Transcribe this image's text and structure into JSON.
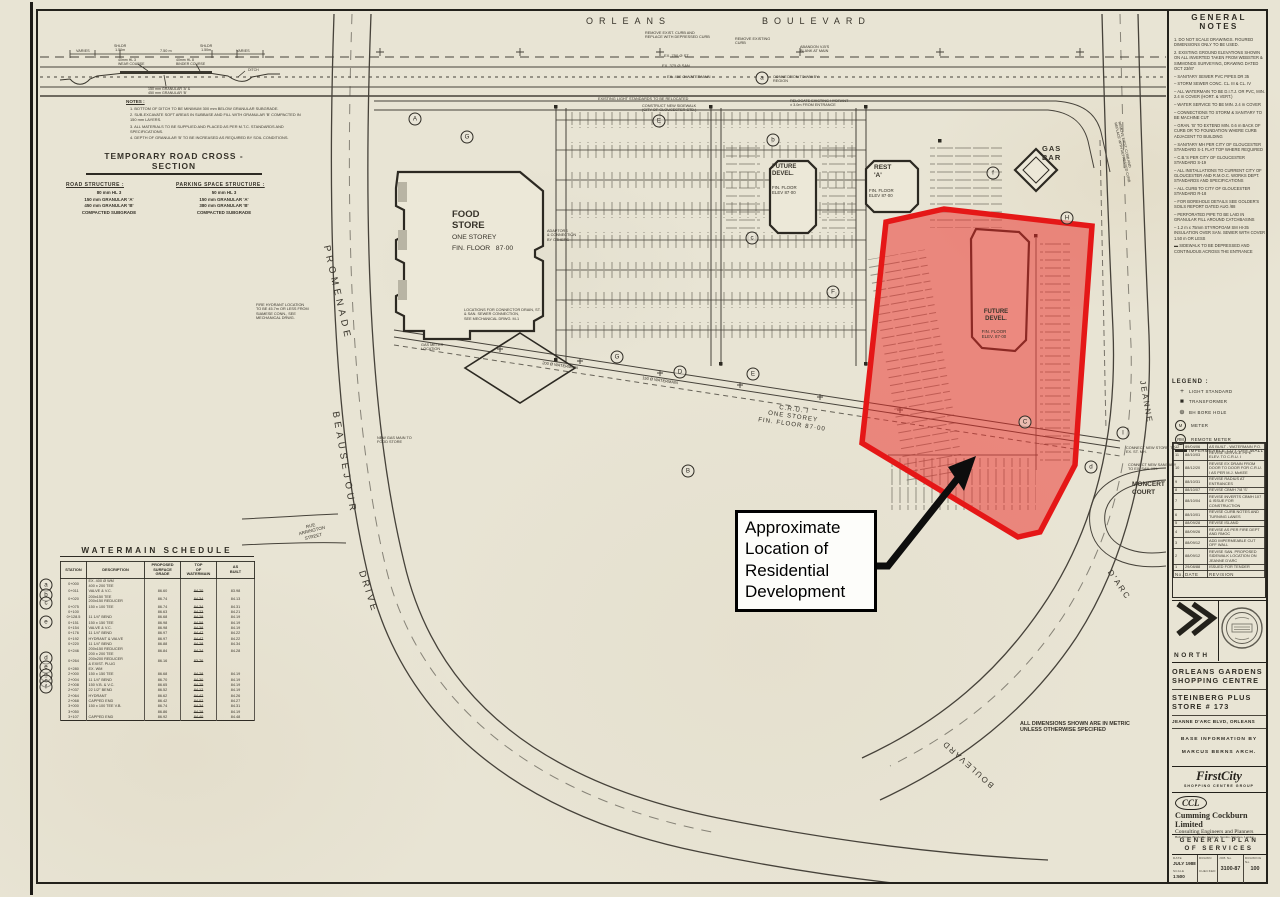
{
  "annotation": {
    "text": "Approximate\nLocation of\nResidential\nDevelopment"
  },
  "colors": {
    "paper": "#e8e4d4",
    "ink": "#2f2c24",
    "highlight_fill": "rgba(236,42,38,0.5)",
    "highlight_stroke": "#e51717",
    "arrow": "#0d0d0d"
  },
  "general_notes": {
    "title": "GENERAL NOTES",
    "items": [
      "1.  DO NOT SCALE DRAWINGS. FIGURED DIMENSIONS ONLY TO BE USED.",
      "2.  EXISTING GROUND ELEVATIONS SHOWN ON ALL INVERTED TAKEN FROM WEBSTER & SIMMONDS SURVEYING, DRAWING DATED OCT 23/87",
      "–  SANITARY SEWER PVC PIPES DR 35",
      "–  STORM SEWER CONC. CL. III & CL. IV",
      "–  ALL WATERMAIN TO BE D.I.T.J. OR PVC, MIN. 2.4 m COVER (HORT. & VERT.)",
      "–  WATER SERVICE TO BE MIN. 2.4 m COVER",
      "–  CONNECTIONS TO STORM & SANITARY TO BE MACHINE CUT",
      "–  GRAN. 'B' TO EXTEND MIN. 0.6 m BACK OF CURB OR TO FOUNDATION WHERE CURB ADJACENT TO BUILDING",
      "–  SANITARY MH PER CITY OF GLOUCESTER STANDARD S-1 FLAT TOP WHERE REQUIRED",
      "–  C.B.'S PER CITY OF GLOUCESTER STANDARD S-19",
      "–  ALL INSTALLATIONS TO CURRENT CITY OF GLOUCESTER AND R.M.O.C. WORKS DEPT. STANDARDS AND SPECIFICATIONS",
      "–  ALL CURB TO CITY OF GLOUCESTER STANDARD R-18",
      "–  FOR BOREHOLE DETAILS SEE GOLDER'S SOILS REPORT DATED AUG /88",
      "–  PERFORATED PIPE TO BE LAID IN GRANULAR FILL AROUND CATCHBASINS",
      "–  1.2 m x 75mm STYROFOAM SM HI-35 INSULATION OVER SAN. SEWER WITH COVER 1.50 m OR LESS",
      "▬  SIDEWALK TO BE DEPRESSED AND CONTINUOUS ACROSS THE ENTRANCE"
    ]
  },
  "legend": {
    "title": "LEGEND :",
    "items": [
      {
        "sym": "+",
        "cls": "plus",
        "label": "LIGHT STANDARD"
      },
      {
        "sym": "■",
        "cls": "sq",
        "label": "TRANSFORMER"
      },
      {
        "sym": "⊕",
        "cls": "bh",
        "label": "BH  BORE HOLE"
      },
      {
        "sym": "M",
        "cls": "circ",
        "label": "METER"
      },
      {
        "sym": "RM",
        "cls": "circ",
        "label": "REMOTE METER"
      },
      {
        "sym": "",
        "cls": "bar",
        "label": "IMPERMEABLE CUT OFF WALL"
      }
    ]
  },
  "revisions": {
    "headers": [
      "No.",
      "DATE",
      "REVISION"
    ],
    "rows": [
      [
        "12",
        "89/04/06",
        "AS BUILT - WATERMAIN   P.O."
      ],
      [
        "11",
        "88/10/03",
        "REVISE SERVICE PIPE ELEV. TO C.R.U. I"
      ],
      [
        "10",
        "88/12/20",
        "REVISE EX DRAIN FROM DOOR TO DOOR FOR C.R.U. I AS PER M.J. McKEE"
      ],
      [
        "9",
        "88/10/31",
        "REVISE RADIUS AT ENTRANCES"
      ],
      [
        "8",
        "88/10/07",
        "REVISE CBMH 7/8 'S'"
      ],
      [
        "7",
        "88/10/04",
        "REVISE INVERTS CBMH 107 & ISSUE FOR CONSTRUCTION"
      ],
      [
        "6",
        "88/10/01",
        "REVISE CURB NOTES AND TURNING LANES"
      ],
      [
        "5",
        "88/09/28",
        "REVISE ISLAND"
      ],
      [
        "4",
        "88/09/26",
        "REVISE AS PER FIRE DEPT AND RMOC"
      ],
      [
        "3",
        "88/09/12",
        "ADD IMPERMEABLE CUT OFF WALL"
      ],
      [
        "2",
        "88/09/12",
        "REVISE SAN. PROPOSED SIDEWALK LOCATION ON JEANNE D'ARC"
      ],
      [
        "1",
        "29/08/88",
        "ISSUED FOR TENDER"
      ]
    ]
  },
  "title_block": {
    "north_label": "NORTH",
    "project_line1": "ORLEANS GARDENS\nSHOPPING CENTRE",
    "project_line2": "STEINBERG PLUS\nSTORE # 173",
    "address": "JEANNE D'ARC BLVD, ORLEANS",
    "base_info1": "BASE  INFORMATION  BY",
    "base_info2": "MARCUS  BERNS  ARCH.",
    "firstcity_logo": "FirstCity",
    "firstcity_sub": "SHOPPING CENTRE GROUP",
    "ccl_logo": "CCL",
    "ccl_name": "Cumming Cockburn Limited",
    "ccl_tag": "Consulting Engineers and Planners",
    "ccl_cities": "Hull, Ottawa, Brockville, Kingston, Toronto, Waterloo, London",
    "drawing_title": "GENERAL   PLAN\nOF   SERVICES",
    "fields": {
      "date_label": "DATE",
      "date_value": "JULY 1988",
      "scale_label": "SCALE",
      "scale_value": "1:500",
      "drawn_label": "DRAWN",
      "checked_label": "CHECKED",
      "job_label": "JOB No.",
      "job_value": "3100-87",
      "dwg_label": "DRAWING No.",
      "dwg_value": "100"
    }
  },
  "cross_section": {
    "title": "TEMPORARY  ROAD  CROSS - SECTION",
    "notes_title": "NOTES :",
    "notes": [
      "1.  BOTTOM OF DITCH TO BE MINIMUM 300 mm BELOW GRANULAR SUBGRADE.",
      "2.  SUB-EXCAVATE SOFT AREAS IN SUBBASE AND FILL WITH GRANULAR 'B' COMPACTED IN 150 mm LAYERS.",
      "3.  ALL MATERIALS TO BE SUPPLIED AND PLACED AS PER M.T.C. STANDARDS AND SPECIFICATIONS.",
      "4.  DEPTH OF GRANULAR 'B' TO BE INCREASED AS REQUIRED BY SOIL CONDITIONS."
    ],
    "road_structure_title": "ROAD  STRUCTURE :",
    "road_structure_lines": "80 mm HL 3\n150 mm GRANULAR 'A'\n450 mm GRANULAR 'B'\nCOMPACTED SUBGRADE",
    "parking_structure_title": "PARKING  SPACE  STRUCTURE :",
    "parking_structure_lines": "50 mm HL 3\n150 mm GRANULAR 'A'\n380 mm GRANULAR 'B'\nCOMPACTED SUBGRADE"
  },
  "watermain_schedule": {
    "title": "WATERMAIN  SCHEDULE",
    "headers": [
      "STATION",
      "DESCRIPTION",
      "PROPOSED\nSURFACE\nGRADE",
      "TOP\nOF\nWATERMAIN",
      "AS\nBUILT"
    ],
    "rows": [
      [
        "0+000",
        "EX. 400 Ø WM\n400 x 200 TEE",
        "",
        "",
        ""
      ],
      [
        "0+011",
        "VALVE & V.C.",
        "86.60",
        "84.20",
        "83.98"
      ],
      [
        "0+020",
        "200x150 TEE\n200x150 REDUCER",
        "86.74",
        "84.34",
        "84.13"
      ],
      [
        "0+075",
        "150 x 100 TEE",
        "86.74",
        "84.34",
        "84.31"
      ],
      [
        "0+100",
        "",
        "86.63",
        "84.23",
        "84.21"
      ],
      [
        "0+128.5",
        "11 1/4° BEND",
        "86.68",
        "84.28",
        "84.19"
      ],
      [
        "0+151",
        "150 x 150 TEE",
        "86.98",
        "84.58",
        "84.19"
      ],
      [
        "0+154",
        "VALVE & V.C.",
        "86.98",
        "84.38",
        "84.19"
      ],
      [
        "0+176",
        "11 1/4° BEND",
        "86.97",
        "84.47",
        "84.22"
      ],
      [
        "0+192",
        "HYDRANT & VALVE",
        "86.97",
        "84.47",
        "84.22"
      ],
      [
        "0+220",
        "11 1/4° BEND",
        "86.88",
        "84.28",
        "84.34"
      ],
      [
        "0+246",
        "200x150 REDUCER\n200 x 200 TEE",
        "86.84",
        "84.24",
        "84.28"
      ],
      [
        "0+264",
        "200x200 REDUCER\n& EXIST. PLUG",
        "86.16",
        "83.76",
        ""
      ],
      [
        "0+280",
        "EX.  WM",
        "",
        "",
        ""
      ],
      [
        "2+000",
        "150 x 150 TEE",
        "86.68",
        "84.28",
        "84.19"
      ],
      [
        "2+004",
        "11 1/4° BEND",
        "86.70",
        "84.30",
        "84.19"
      ],
      [
        "2+008",
        "150 V.B. & V.C.",
        "86.65",
        "84.25",
        "84.19"
      ],
      [
        "2+037",
        "22 1/2° BEND",
        "86.52",
        "84.12",
        "84.19"
      ],
      [
        "2+064",
        "HYDRANT",
        "86.62",
        "84.42",
        "84.26"
      ],
      [
        "2+068",
        "CAPPED END",
        "86.42",
        "84.02",
        "84.27"
      ],
      [
        "3+000",
        "150 x 100 TEE V.B.",
        "86.74",
        "84.34",
        "84.31"
      ],
      [
        "3+050",
        "",
        "86.86",
        "84.28",
        "84.19"
      ],
      [
        "3+107",
        "CAPPED END",
        "86.92",
        "84.40",
        "84.48"
      ]
    ]
  },
  "plan": {
    "labels": [
      {
        "t": "ORLEANS",
        "x": 586,
        "y": 16,
        "s": 9,
        "ls": 6,
        "n": "street-label-orleans"
      },
      {
        "t": "BOULEVARD",
        "x": 762,
        "y": 16,
        "s": 9,
        "ls": 6,
        "n": "street-label-boulevard-top"
      },
      {
        "t": "PROMENADE",
        "cx": 337,
        "cy": 293,
        "s": 9.5,
        "ls": 4,
        "r": 77,
        "n": "street-label-promenade"
      },
      {
        "t": "BEAUSEJOUR",
        "cx": 344,
        "cy": 463,
        "s": 9.5,
        "ls": 4,
        "r": 80,
        "n": "street-label-beausejour"
      },
      {
        "t": "DRIVE",
        "cx": 368,
        "cy": 592,
        "s": 9.5,
        "ls": 3,
        "r": 72,
        "n": "street-label-drive"
      },
      {
        "t": "RUE\nARRINGTON\nSTREET",
        "cx": 312,
        "cy": 531,
        "s": 4.5,
        "r": -14,
        "al": "center",
        "n": "street-label-rue-arrington"
      },
      {
        "t": "JEANNE",
        "cx": 1146,
        "cy": 402,
        "s": 8,
        "ls": 2,
        "r": 80,
        "n": "street-label-jeanne"
      },
      {
        "t": "MONCERT\nCOURT",
        "x": 1132,
        "y": 481,
        "s": 6.5,
        "w": 700,
        "n": "street-label-moncert-court"
      },
      {
        "t": "D'ARC",
        "cx": 1119,
        "cy": 585,
        "s": 8,
        "ls": 2,
        "r": 56,
        "n": "street-label-darc"
      },
      {
        "t": "BOULEVARD",
        "cx": 968,
        "cy": 764,
        "s": 8,
        "ls": 2,
        "r": 222,
        "n": "street-label-boulevard-bottom"
      },
      {
        "t": "FOOD\nSTORE",
        "x": 452,
        "y": 209,
        "s": 9.5,
        "w": 700,
        "n": "building-label-food-store"
      },
      {
        "t": "ONE STOREY",
        "x": 452,
        "y": 234,
        "s": 6.8,
        "n": "building-label-food-store-storey"
      },
      {
        "t": "FIN. FLOOR   87·00",
        "x": 452,
        "y": 245,
        "s": 6.8,
        "n": "building-label-food-store-floor"
      },
      {
        "t": "FUTURE\nDEVEL.",
        "x": 772,
        "y": 164,
        "s": 6,
        "w": 700,
        "n": "building-label-future-devel-north"
      },
      {
        "t": "FIN. FLOOR\nELEV 87·00",
        "x": 772,
        "y": 185,
        "s": 4.4,
        "n": "building-label-future-devel-north-floor"
      },
      {
        "t": "REST\n'A'",
        "x": 874,
        "y": 164,
        "s": 6.5,
        "w": 700,
        "n": "building-label-rest-a"
      },
      {
        "t": "FIN. FLOOR\nELEV 87·00",
        "x": 869,
        "y": 188,
        "s": 4.4,
        "n": "building-label-rest-a-floor"
      },
      {
        "t": "GAS\nBAR",
        "x": 1042,
        "y": 145,
        "s": 7.5,
        "w": 700,
        "ls": 1,
        "n": "building-label-gas-bar"
      },
      {
        "t": "C.R.U. I\nONE STOREY\nFIN. FLOOR 87·00",
        "cx": 793,
        "cy": 417,
        "s": 6.2,
        "r": 8,
        "al": "center",
        "ls": 1,
        "n": "building-label-cru-1"
      },
      {
        "t": "FUTURE\nDEVEL.",
        "cx": 996,
        "cy": 316,
        "s": 6,
        "w": 700,
        "al": "center",
        "n": "building-label-future-devel-red-area"
      },
      {
        "t": "FIN. FLOOR\nELEV. 87·00",
        "cx": 994,
        "cy": 334,
        "s": 4.4,
        "al": "center",
        "n": "building-label-future-devel-red-area-floor"
      },
      {
        "t": "ALL DIMENSIONS SHOWN ARE IN METRIC\nUNLESS OTHERWISE SPECIFIED",
        "x": 1020,
        "y": 721,
        "s": 5.4,
        "w": 700,
        "n": "note-metric-units"
      },
      {
        "t": "EX. 750 Ø ST",
        "x": 664,
        "y": 54,
        "s": 4
      },
      {
        "t": "EX. 375 Ø SAN",
        "x": 662,
        "y": 64,
        "s": 4
      },
      {
        "t": "EX. 400 Ø WATERMAIN",
        "x": 667,
        "y": 75,
        "s": 4
      },
      {
        "t": "REMOVE EXIST. CURB AND\nREPLACE WITH DEPRESSED CURB",
        "x": 645,
        "y": 31,
        "s": 3.8
      },
      {
        "t": "REMOVE EXISTING\nCURB",
        "x": 735,
        "y": 37,
        "s": 3.8
      },
      {
        "t": "ABANDON V-B'S\nBLANK AT MAIN",
        "x": 800,
        "y": 45,
        "s": 3.8
      },
      {
        "t": "CONNECTION TO WM BY\nREGION",
        "x": 773,
        "y": 75,
        "s": 3.8
      },
      {
        "t": "EXISTING LIGHT STANDARDS TO BE RELOCATED",
        "x": 598,
        "y": 97,
        "s": 3.8
      },
      {
        "t": "CONSTRUCT NEW SIDEWALK\n(CITY OF GLOUCESTER STD.)",
        "x": 642,
        "y": 104,
        "s": 3.8
      },
      {
        "t": "RELOCATE EXISTING HYDRANT\n± 3.0m FROM ENTRANCE",
        "x": 790,
        "y": 99,
        "s": 3.8
      },
      {
        "t": "LOCATIONS FOR CONNECTOR DRAIN, ST.\n& SAN. SEWER CONNECTION,\nSEE MECHANICAL DRWG. M-1",
        "x": 464,
        "y": 308,
        "s": 3.8
      },
      {
        "t": "GAS METER\nLOCATION",
        "x": 421,
        "y": 343,
        "s": 3.8
      },
      {
        "t": "ADAPTORS\n& CONNECTION\nBY OTHERS",
        "x": 547,
        "y": 229,
        "s": 3.8
      },
      {
        "t": "FIRE HYDRANT LOCATION\nTO BE 45.7m OR LESS FROM\nSIAMESE CONN., SEE\nMECHANICAL DRWG.",
        "x": 256,
        "y": 303,
        "s": 3.8
      },
      {
        "t": "NEW GAS MAIN TO\nFOOD STORE",
        "x": 377,
        "y": 436,
        "s": 3.8
      },
      {
        "t": "CONNECT NEW STORM TO\nEX. ST. MH.",
        "x": 1126,
        "y": 446,
        "s": 3.8
      },
      {
        "t": "CONNECT NEW SANITARY\nTO EX. SAN. MH.",
        "x": 1128,
        "y": 463,
        "s": 3.8
      },
      {
        "t": "150 Ø WATERMAIN",
        "cx": 660,
        "cy": 381,
        "s": 4,
        "r": 8
      },
      {
        "t": "200 Ø WATERMAIN",
        "cx": 560,
        "cy": 366,
        "s": 4,
        "r": 8
      },
      {
        "t": "REMOVE EXIST. CURB AND\nREPLACE WITH DEPRESSED CURB",
        "cx": 1124,
        "cy": 152,
        "s": 3.6,
        "r": 77
      },
      {
        "t": "VARIES",
        "x": 76,
        "y": 49,
        "s": 3.8
      },
      {
        "t": "SHLDR\n1.50m",
        "x": 114,
        "y": 44,
        "s": 3.6,
        "al": "center"
      },
      {
        "t": "7.50 m",
        "x": 160,
        "y": 49,
        "s": 3.8
      },
      {
        "t": "SHLDR\n1.50m",
        "x": 200,
        "y": 44,
        "s": 3.6,
        "al": "center"
      },
      {
        "t": "VARIES",
        "x": 236,
        "y": 49,
        "s": 3.8
      },
      {
        "t": "40mm HL 3\nWEAR COURSE",
        "x": 118,
        "y": 58,
        "s": 3.5
      },
      {
        "t": "40mm HL 8\nBINDER COURSE",
        "x": 176,
        "y": 58,
        "s": 3.5
      },
      {
        "t": "DITCH",
        "x": 248,
        "y": 68,
        "s": 3.5
      },
      {
        "t": "150 mm GRANULAR 'A' &\n450 mm GRANULAR 'B'",
        "x": 148,
        "y": 87,
        "s": 3.6
      }
    ],
    "markers": [
      {
        "t": "a",
        "x": 762,
        "y": 78
      },
      {
        "t": "A",
        "x": 415,
        "y": 119
      },
      {
        "t": "G",
        "x": 467,
        "y": 137
      },
      {
        "t": "E",
        "x": 659,
        "y": 121
      },
      {
        "t": "b",
        "x": 773,
        "y": 140
      },
      {
        "t": "f",
        "x": 993,
        "y": 173
      },
      {
        "t": "H",
        "x": 1067,
        "y": 218
      },
      {
        "t": "c",
        "x": 752,
        "y": 238
      },
      {
        "t": "F",
        "x": 833,
        "y": 292
      },
      {
        "t": "G",
        "x": 617,
        "y": 357
      },
      {
        "t": "D",
        "x": 680,
        "y": 372
      },
      {
        "t": "E",
        "x": 753,
        "y": 374
      },
      {
        "t": "C",
        "x": 1025,
        "y": 422
      },
      {
        "t": "B",
        "x": 688,
        "y": 471
      },
      {
        "t": "I",
        "x": 1123,
        "y": 433
      },
      {
        "t": "d",
        "x": 1091,
        "y": 467
      },
      {
        "t": "a",
        "x": 46,
        "y": 585
      },
      {
        "t": "b",
        "x": 46,
        "y": 595
      },
      {
        "t": "c",
        "x": 46,
        "y": 603
      },
      {
        "t": "e",
        "x": 46,
        "y": 622
      },
      {
        "t": "d",
        "x": 46,
        "y": 658
      },
      {
        "t": "e",
        "x": 46,
        "y": 667
      },
      {
        "t": "g",
        "x": 46,
        "y": 675
      },
      {
        "t": "c",
        "x": 46,
        "y": 681
      },
      {
        "t": "f",
        "x": 46,
        "y": 687
      }
    ]
  }
}
